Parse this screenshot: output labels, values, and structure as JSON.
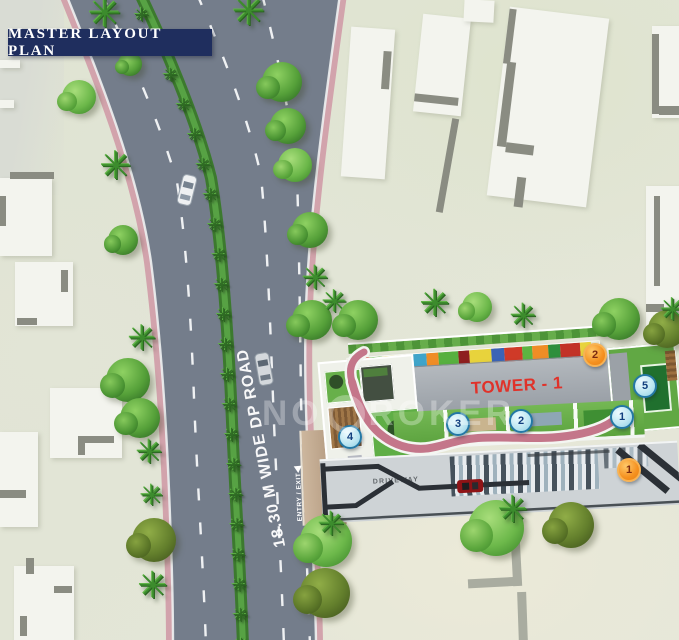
{
  "title": "MASTER LAYOUT PLAN",
  "watermark": {
    "prefix": "NO",
    "suffix": "ROKER"
  },
  "road": {
    "name": "18.30 M WIDE DP ROAD",
    "entry_exit": "ENTRY / EXIT"
  },
  "tower": {
    "label": "TOWER - 1"
  },
  "driveway": {
    "label": "DRIVEWAY"
  },
  "markers": {
    "orange_2": "2",
    "orange_1": "1",
    "blue_5": "5",
    "blue_1": "1",
    "blue_2": "2",
    "blue_3": "3",
    "blue_4": "4"
  },
  "colors": {
    "banner_navy": "#1f2e5e",
    "road_gray": "#747d8b",
    "sidewalk_pink": "#d2a3ac",
    "median_green": "#3c7a2e",
    "tower_gray": "#a3a9af",
    "tower_text_red": "#e0322a",
    "marker_blue_fill": "#bfe7f2",
    "marker_orange_fill": "#f59120",
    "lawn_green": "#6ab04a",
    "path_pink": "#c4768a",
    "strip_palette": [
      "#cf3a28",
      "#5cb441",
      "#e8d33c",
      "#c23227",
      "#3fa4c9",
      "#ef8d26",
      "#57b03f",
      "#8e1f1f",
      "#e8d33c",
      "#3b63b5",
      "#cf3a28",
      "#5cb441",
      "#ef8d26",
      "#2e8f3c",
      "#c23227",
      "#e8d33c"
    ]
  }
}
